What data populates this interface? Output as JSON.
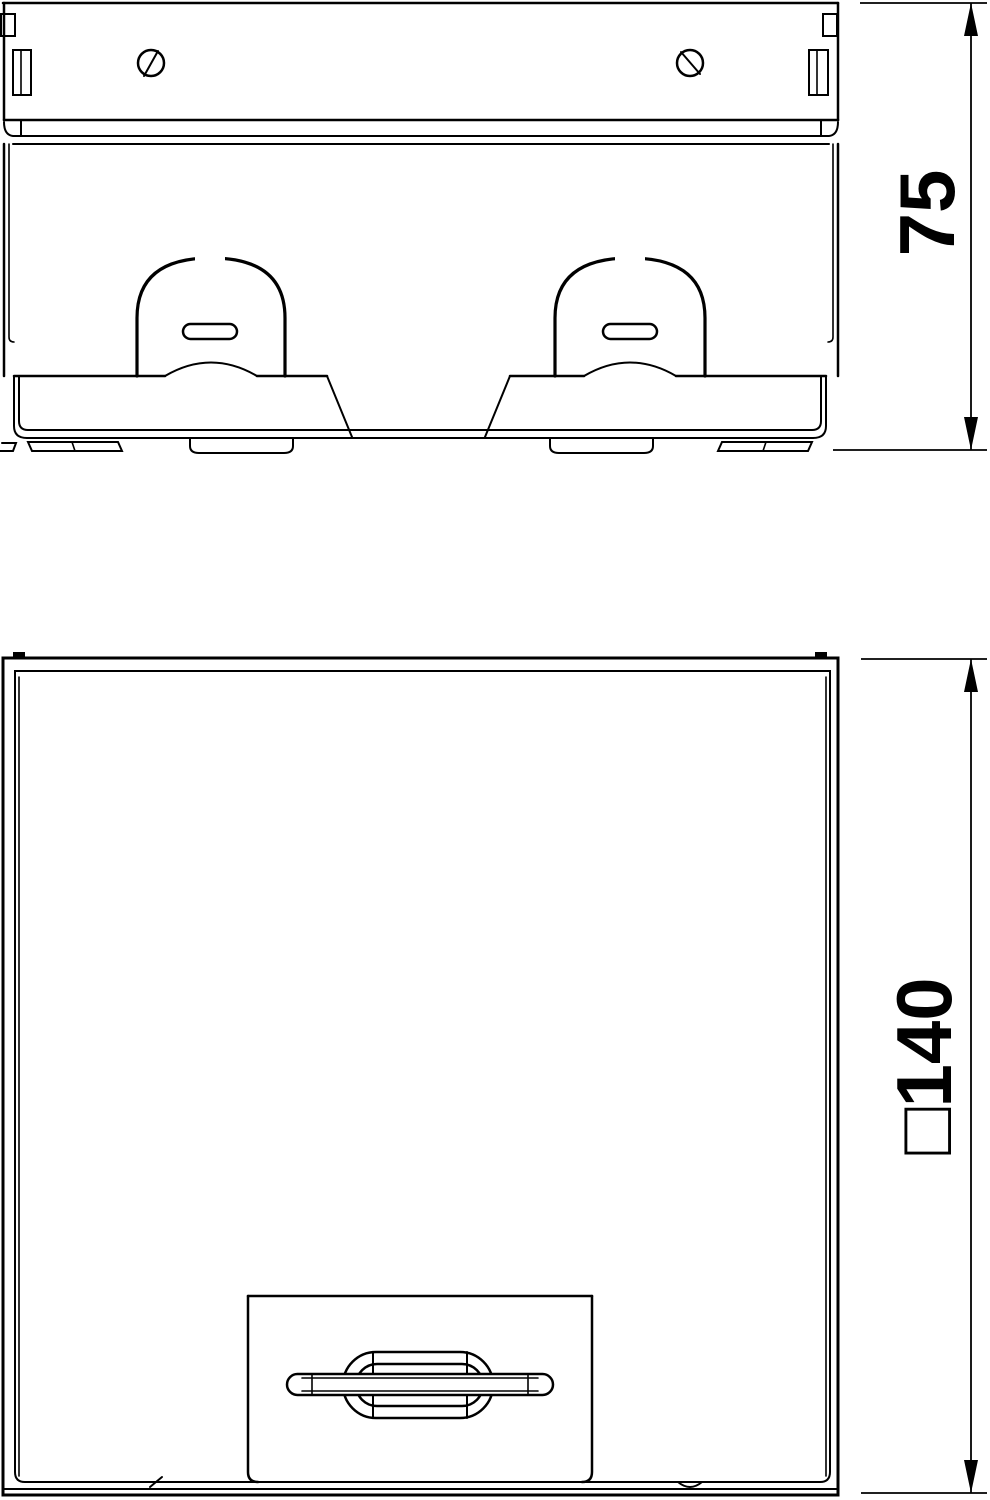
{
  "style": {
    "background": "#ffffff",
    "line_color": "#000000"
  },
  "front_view": {
    "dimension_height": {
      "value": "75"
    }
  },
  "plan_view": {
    "dimension_side": {
      "value": "□140"
    }
  }
}
